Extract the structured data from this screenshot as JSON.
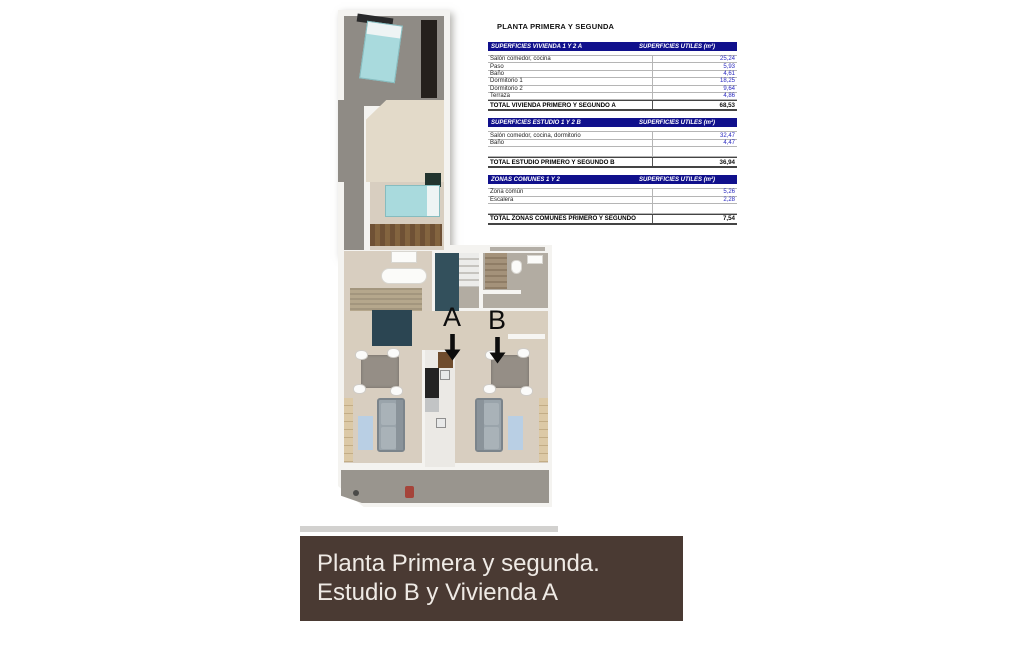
{
  "title": "PLANTA PRIMERA Y SEGUNDA",
  "table": {
    "sections": [
      {
        "header_left": "SUPERFICIES VIVIENDA 1 Y 2 A",
        "header_right": "SUPERFICIES UTILES  (m²)",
        "rows": [
          {
            "label": "Salón comedor, cocina",
            "value": "25,24"
          },
          {
            "label": "Paso",
            "value": "5,93"
          },
          {
            "label": "Baño",
            "value": "4,61"
          },
          {
            "label": "Dormitorio 1",
            "value": "18,25"
          },
          {
            "label": "Dormitorio 2",
            "value": "9,64"
          },
          {
            "label": "Terraza",
            "value": "4,86"
          }
        ],
        "total_label": "TOTAL VIVIENDA PRIMERO Y SEGUNDO A",
        "total_value": "68,53"
      },
      {
        "header_left": "SUPERFICIES ESTUDIO 1 Y 2 B",
        "header_right": "SUPERFICIES UTILES  (m²)",
        "rows": [
          {
            "label": "Salón comedor, cocina, dormitorio",
            "value": "32,47"
          },
          {
            "label": "Baño",
            "value": "4,47"
          }
        ],
        "total_label": "TOTAL ESTUDIO PRIMERO Y SEGUNDO B",
        "total_value": "36,94"
      },
      {
        "header_left": "ZONAS COMUNES 1 Y 2",
        "header_right": "SUPERFICIES UTILES  (m²)",
        "rows": [
          {
            "label": "Zona común",
            "value": "5,26"
          },
          {
            "label": "Escalera",
            "value": "2,28"
          }
        ],
        "total_label": "TOTAL ZONAS COMUNES PRIMERO Y SEGUNDO",
        "total_value": "7,54"
      }
    ]
  },
  "floorplan": {
    "unit_a_label": "A",
    "unit_b_label": "B"
  },
  "banner": {
    "line1": "Planta Primera y segunda.",
    "line2": "Estudio B y Vivienda A",
    "background_color": "#4a3a33",
    "text_color": "#efeae5"
  },
  "colors": {
    "table_header_bg": "#10108c",
    "table_header_text": "#ffffff",
    "table_value_text": "#2a2ac0",
    "floor_beige": "#d8cec0",
    "floor_gray": "#8f8b85",
    "bed_teal": "#a9dadd",
    "bathroom_navy": "#2b4552",
    "wood_brown": "#6f5135"
  }
}
